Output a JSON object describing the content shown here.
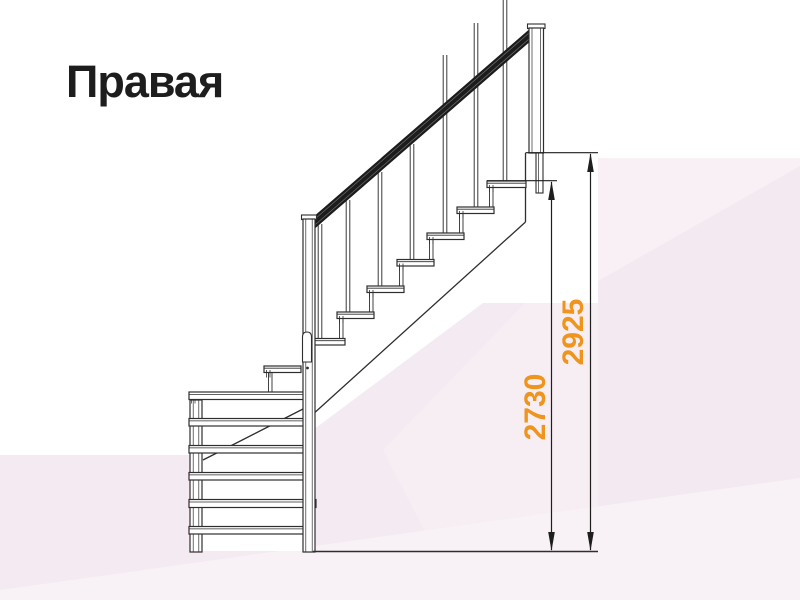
{
  "title": {
    "text": "Правая",
    "color": "#1D1D1D"
  },
  "diagram": {
    "description": "Side elevation drawing of a right-hand quarter-turn wooden staircase with handrail, balusters, two newel posts and a lower flight seen front-on",
    "dimensions": [
      {
        "id": "height-to-top-tread",
        "label": "2730",
        "color": "#EF941D"
      },
      {
        "id": "height-to-landing",
        "label": "2925",
        "color": "#EF941D"
      }
    ],
    "colors": {
      "line": "#2E2E2E",
      "rail": "#1C1C1C",
      "accent": "#EF941D",
      "background_base": "#F4EAF1",
      "background_light": "#F9F0F6",
      "background_white": "#FFFFFF"
    }
  }
}
